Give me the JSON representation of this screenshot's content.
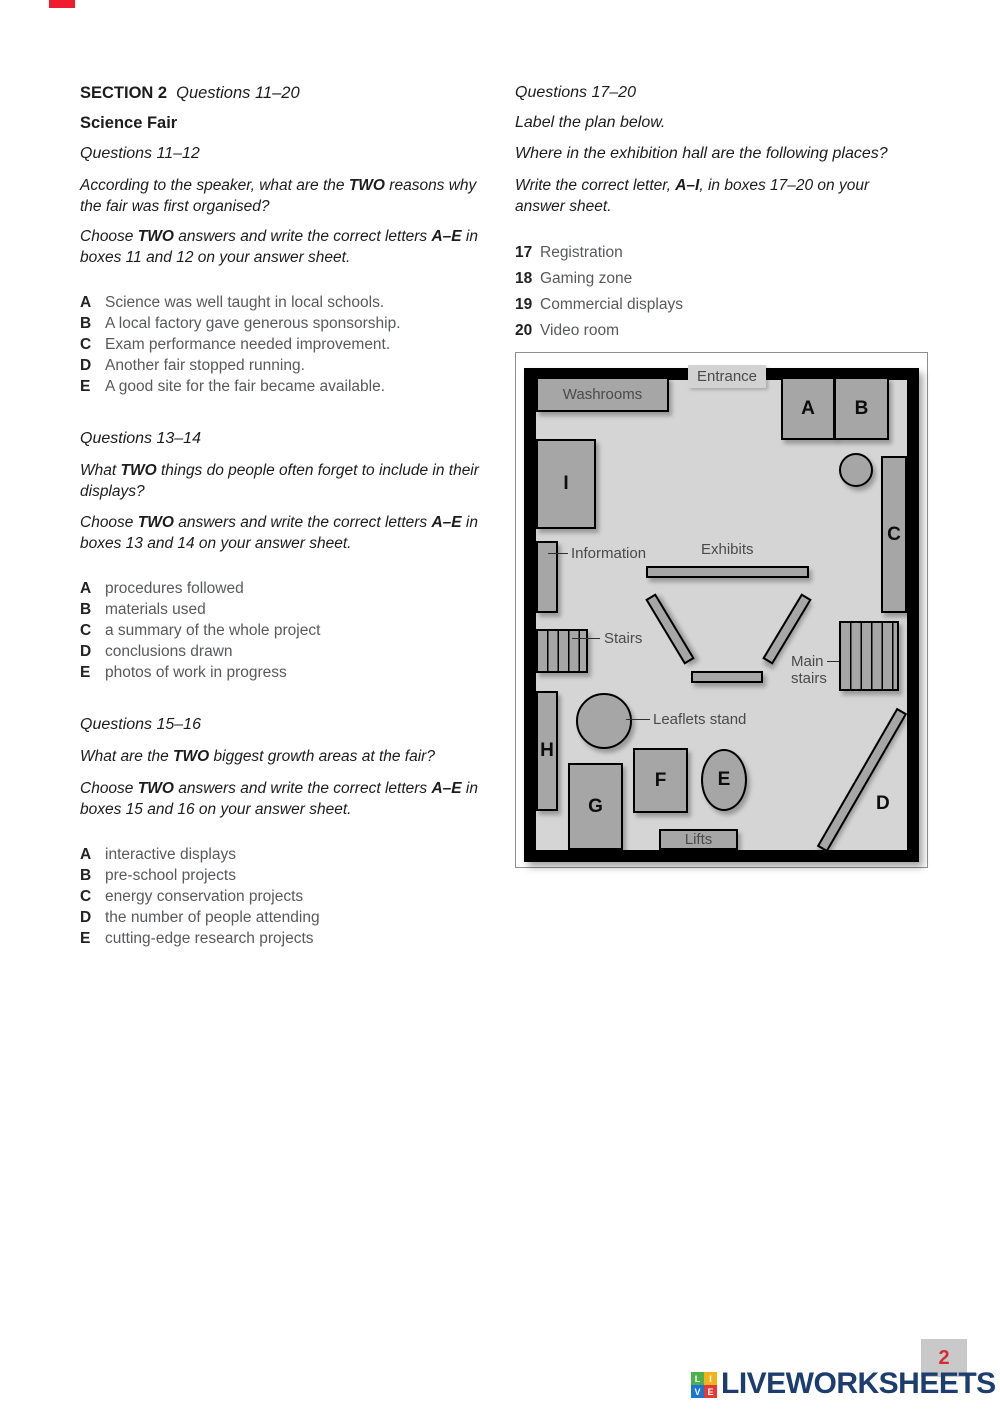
{
  "brand": {
    "corner_mark_color": "#ee1c2c",
    "footer": {
      "logo_text": "LIVEWORKSHEETS",
      "logo_color": "#1d3d6e",
      "squares": [
        {
          "letter": "L",
          "color": "#4caf50"
        },
        {
          "letter": "I",
          "color": "#f2b21c"
        },
        {
          "letter": "V",
          "color": "#1976d2"
        },
        {
          "letter": "E",
          "color": "#e53935"
        }
      ],
      "page_number": "2",
      "page_number_color": "#d22c36"
    }
  },
  "left_column": {
    "section_label": "SECTION 2",
    "section_range": "Questions 11–20",
    "title": "Science Fair",
    "q11_12": {
      "heading": "Questions 11–12",
      "question": {
        "pre": "According to the speaker, what are the ",
        "bold": "TWO",
        "post": " reasons why the fair was first organised?"
      },
      "choose": {
        "pre": "Choose ",
        "bold1": "TWO",
        "mid": " answers and write the correct letters ",
        "bold2": "A–E",
        "post": " in boxes 11 and 12 on your answer sheet."
      },
      "options": [
        {
          "letter": "A",
          "text": "Science was well taught in local schools."
        },
        {
          "letter": "B",
          "text": "A local factory gave generous sponsorship."
        },
        {
          "letter": "C",
          "text": "Exam performance needed improvement."
        },
        {
          "letter": "D",
          "text": "Another fair stopped running."
        },
        {
          "letter": "E",
          "text": "A good site for the fair became available."
        }
      ]
    },
    "q13_14": {
      "heading": "Questions 13–14",
      "question": {
        "pre": "What ",
        "bold": "TWO",
        "post": " things do people often forget to include in their displays?"
      },
      "choose": {
        "pre": "Choose ",
        "bold1": "TWO",
        "mid": " answers and write the correct letters ",
        "bold2": "A–E",
        "post": " in boxes 13 and 14 on your answer sheet."
      },
      "options": [
        {
          "letter": "A",
          "text": "procedures followed"
        },
        {
          "letter": "B",
          "text": "materials used"
        },
        {
          "letter": "C",
          "text": "a summary of the whole project"
        },
        {
          "letter": "D",
          "text": "conclusions drawn"
        },
        {
          "letter": "E",
          "text": "photos of work in progress"
        }
      ]
    },
    "q15_16": {
      "heading": "Questions 15–16",
      "question": {
        "pre": "What are the ",
        "bold": "TWO",
        "post": " biggest growth areas at the fair?"
      },
      "choose": {
        "pre": "Choose ",
        "bold1": "TWO",
        "mid": " answers and write the correct letters ",
        "bold2": "A–E",
        "post": " in boxes 15 and 16 on your answer sheet."
      },
      "options": [
        {
          "letter": "A",
          "text": "interactive displays"
        },
        {
          "letter": "B",
          "text": "pre-school projects"
        },
        {
          "letter": "C",
          "text": "energy conservation projects"
        },
        {
          "letter": "D",
          "text": "the number of people attending"
        },
        {
          "letter": "E",
          "text": "cutting-edge research projects"
        }
      ]
    }
  },
  "right_column": {
    "q17_20": {
      "heading": "Questions 17–20",
      "line1": "Label the plan below.",
      "line2": "Where in the exhibition hall are the following places?",
      "write": {
        "pre": "Write the correct letter, ",
        "bold": "A–I",
        "post": ", in boxes 17–20 on your answer sheet."
      },
      "items": [
        {
          "number": "17",
          "text": "Registration"
        },
        {
          "number": "18",
          "text": "Gaming zone"
        },
        {
          "number": "19",
          "text": "Commercial displays"
        },
        {
          "number": "20",
          "text": "Video room"
        }
      ]
    }
  },
  "plan": {
    "labels": {
      "entrance": "Entrance",
      "washrooms": "Washrooms",
      "information": "Information",
      "exhibits": "Exhibits",
      "stairs": "Stairs",
      "main_stairs_line1": "Main",
      "main_stairs_line2": "stairs",
      "leaflets": "Leaflets stand",
      "lifts": "Lifts"
    },
    "letters": {
      "a": "A",
      "b": "B",
      "c": "C",
      "d": "D",
      "e": "E",
      "f": "F",
      "g": "G",
      "h": "H",
      "i": "I"
    },
    "colors": {
      "wall": "#000000",
      "interior": "#d5d5d5",
      "box": "#a6a6a6",
      "label_text": "#4a4a4a"
    }
  }
}
